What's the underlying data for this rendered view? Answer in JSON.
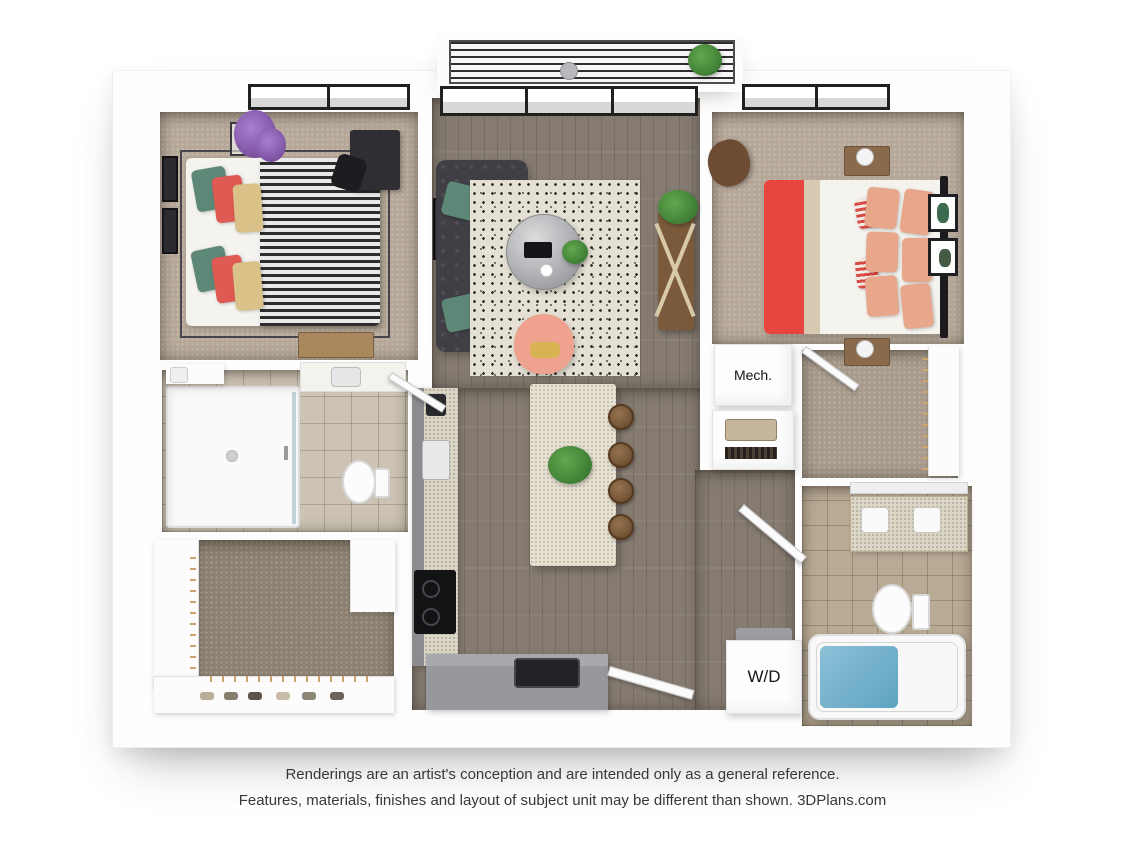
{
  "floorplan": {
    "labels": {
      "mech_closet": "Mech.",
      "washer_dryer": "W/D"
    }
  },
  "disclaimer": {
    "line1": "Renderings are an artist's conception and are intended only as a general reference.",
    "line2": "Features, materials, finishes and layout of subject unit may be different than shown. 3DPlans.com"
  },
  "palette": {
    "background": "#ffffff",
    "wall": "#fdfdfd",
    "bedroom_carpet": "#b6a899",
    "closet_carpet": "#8d8071",
    "wood_floor": "#857b71",
    "bath_tile_light": "#ccc3b4",
    "bath_tile_dark": "#b9aa95",
    "sofa": "#3f3f45",
    "accent_teal": "#5d8877",
    "accent_red": "#e7463f",
    "accent_salmon": "#e8a68b",
    "armchair_pink": "#efa28e",
    "cabinet_gray": "#96989c",
    "tub_water": "#7fb5cf"
  }
}
